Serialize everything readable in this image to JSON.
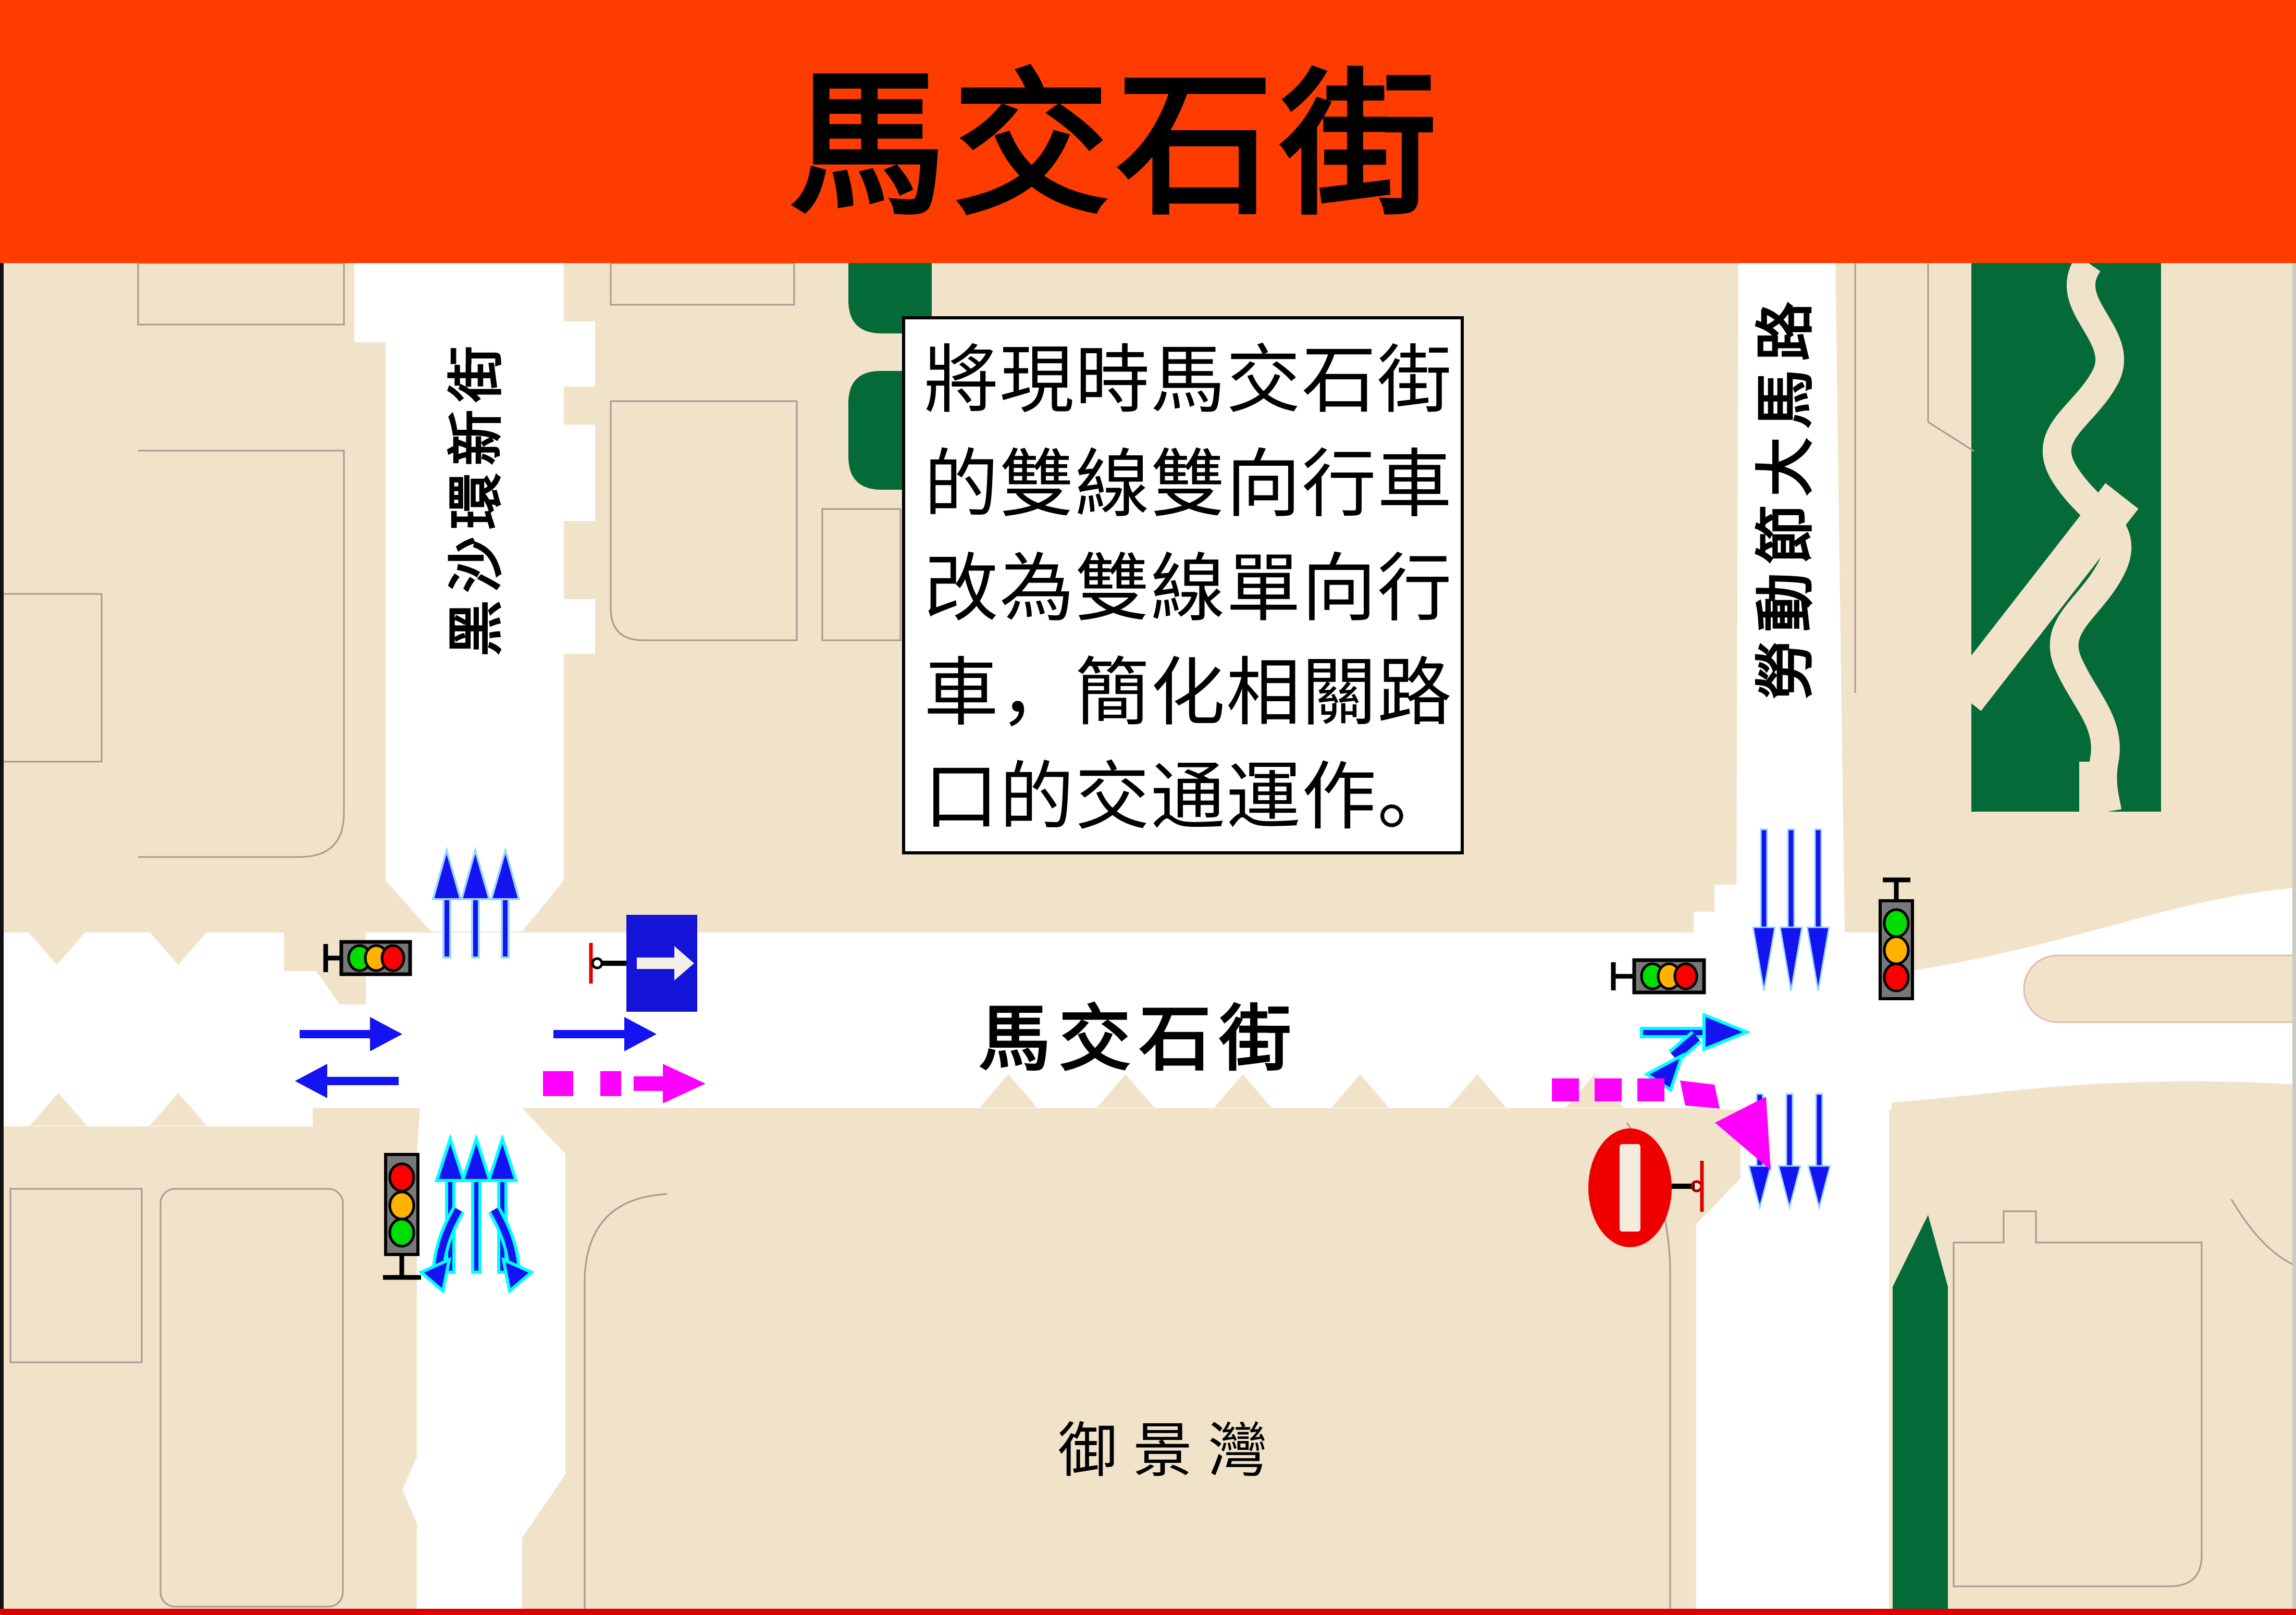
{
  "header": {
    "title": "馬交石街",
    "background_color": "#FF3C00",
    "text_color": "#000000"
  },
  "note_box": {
    "lines": [
      "將現時馬交石街",
      "的雙線雙向行車",
      "改為雙線單向行",
      "車，簡化相關路",
      "口的交通運作。"
    ]
  },
  "street_labels": {
    "left_vertical_road": "黑沙環新街",
    "right_vertical_road": "勞動節大馬路",
    "central_road": "馬交石街",
    "district_area": "御景灣"
  },
  "legend_icons": {
    "traffic_light": "traffic-light-icon",
    "one_way_sign": "one-way-sign-icon",
    "no_entry_sign": "no-entry-sign-icon",
    "traffic_flow_arrow": "blue-flow-arrow",
    "new_routing_arrow": "magenta-dashed-arrow"
  },
  "colors": {
    "block_beige": "#F1E3C9",
    "road_white": "#FFFFFF",
    "park_green": "#046A38",
    "arrow_blue": "#1414F0",
    "arrow_glow_cyan": "#00FFFF",
    "routing_magenta": "#FF00FF",
    "sign_blue": "#1414D9",
    "sign_red": "#EE0000",
    "parcel_outline": "#B09494",
    "bottom_border_red": "#DE0000",
    "left_border_black": "#111111"
  }
}
